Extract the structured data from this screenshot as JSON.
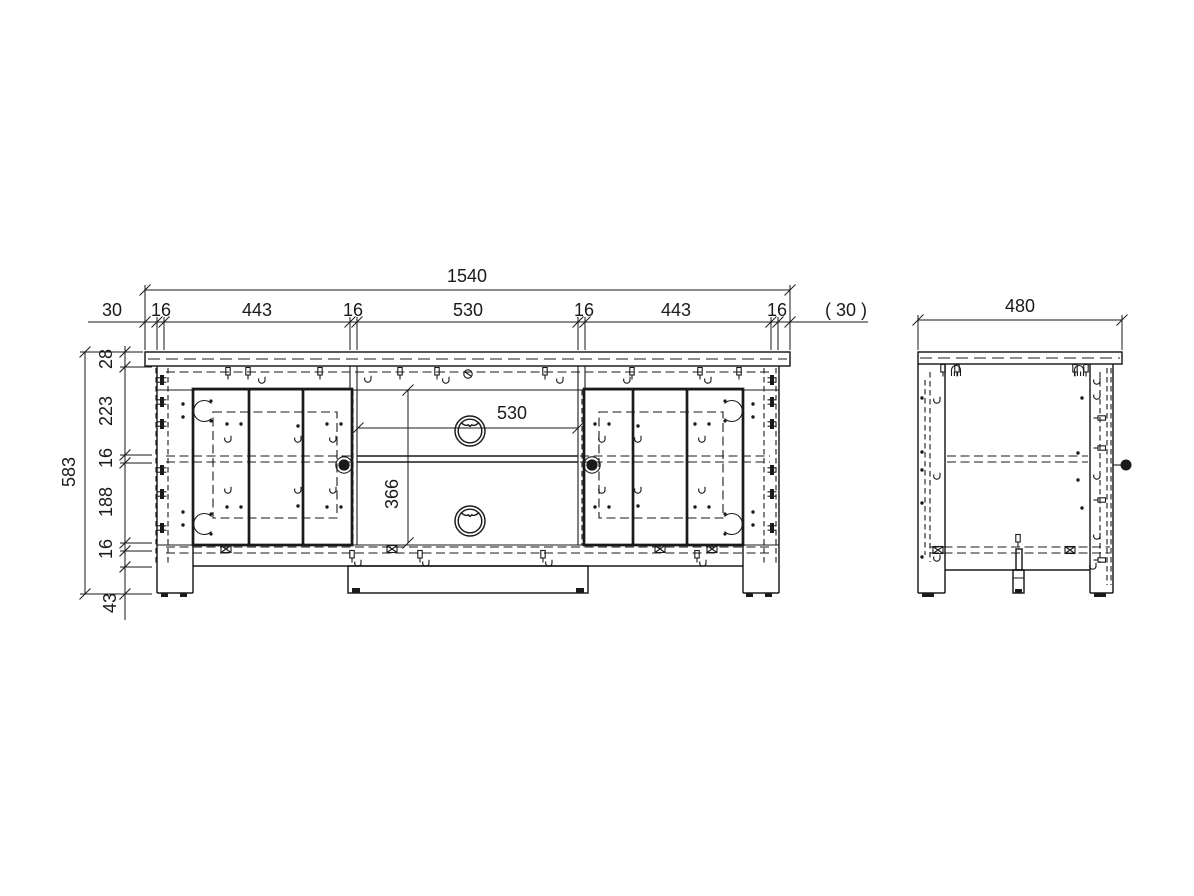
{
  "front_view": {
    "total_width": "1540",
    "width_segments": [
      "30",
      "16",
      "443",
      "16",
      "530",
      "16",
      "443",
      "16"
    ],
    "width_overhang": "( 30 )",
    "total_height": "583",
    "height_segments": [
      "28",
      "223",
      "16",
      "188",
      "16",
      "43"
    ],
    "opening_width": "530",
    "door_height": "366"
  },
  "side_view": {
    "total_depth": "480"
  }
}
